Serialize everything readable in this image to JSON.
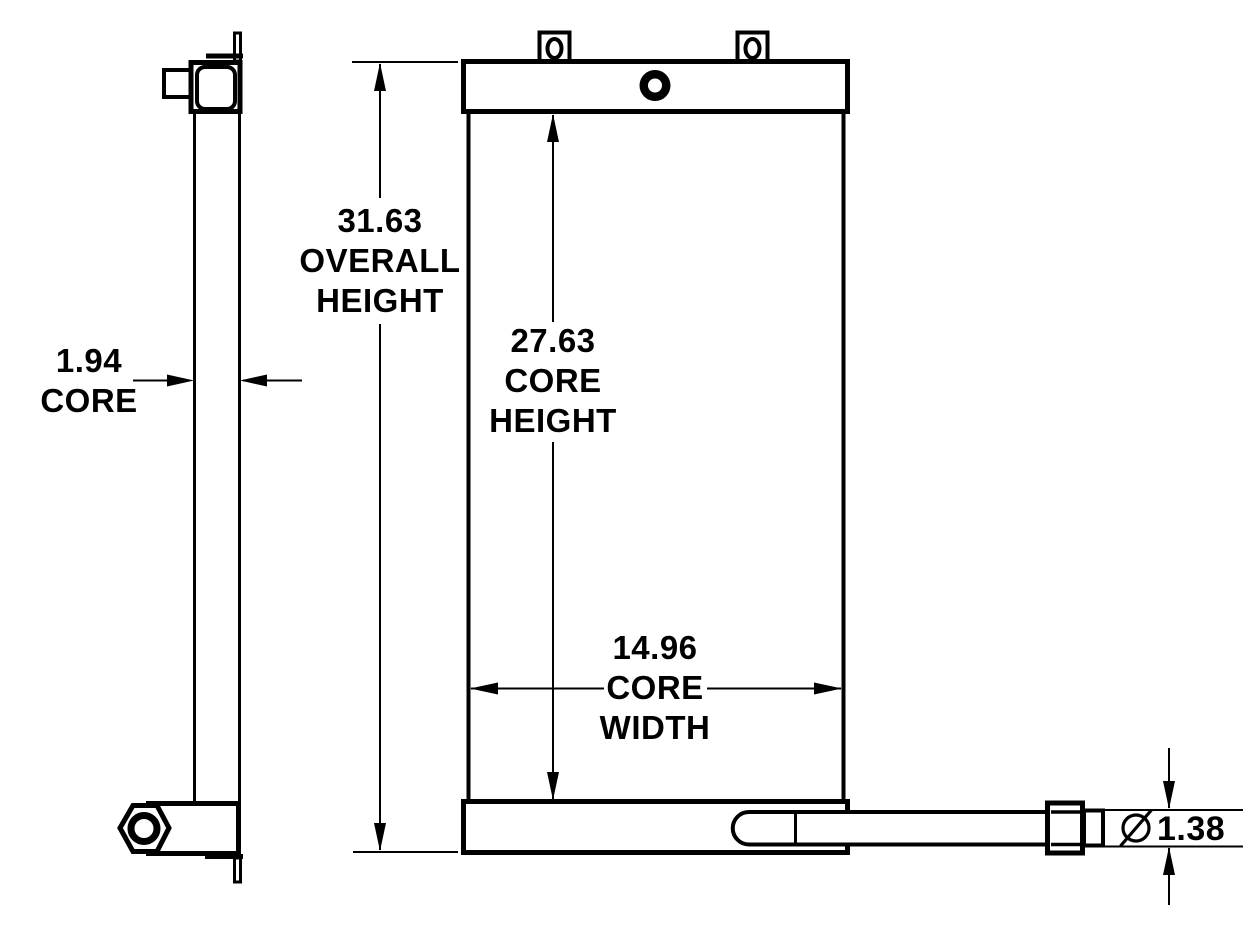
{
  "colors": {
    "background": "#ffffff",
    "line": "#000000",
    "text": "#000000"
  },
  "dimensions": {
    "core_depth": {
      "value": "1.94",
      "label": "CORE"
    },
    "overall_height": {
      "value": "31.63",
      "label1": "OVERALL",
      "label2": "HEIGHT"
    },
    "core_height": {
      "value": "27.63",
      "label1": "CORE",
      "label2": "HEIGHT"
    },
    "core_width": {
      "value": "14.96",
      "label1": "CORE",
      "label2": "WIDTH"
    },
    "tube_diameter": {
      "symbol": "⌀",
      "value": "1.38"
    }
  }
}
